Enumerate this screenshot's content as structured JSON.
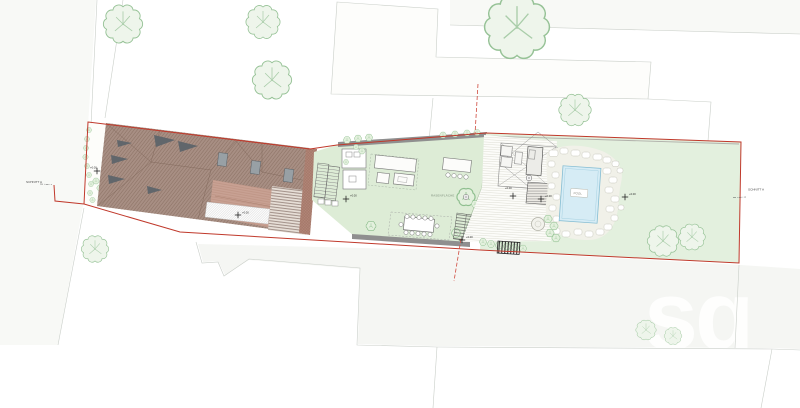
{
  "labels": {
    "section_left": "SCHNITT A",
    "section_right": "SCHNITT A",
    "lawn": "RASENFLÄCHE",
    "pool": "POOL",
    "elevation": "+0.00",
    "watermark": "sq"
  },
  "colors": {
    "boundary_red": "#c0392b",
    "dashed_red": "#cf4a3e",
    "roof_brown": "#a88f84",
    "roof_salmon": "#c8a193",
    "lawn_green": "#ddecd6",
    "lawn_green_right": "#e3f0de",
    "pool_blue": "#d6ecf5",
    "tree_green": "#96c296",
    "wall_gray": "#8f8f8f",
    "parcel_line": "#c9cec8",
    "parcel_fill": "#f5f6f3"
  }
}
